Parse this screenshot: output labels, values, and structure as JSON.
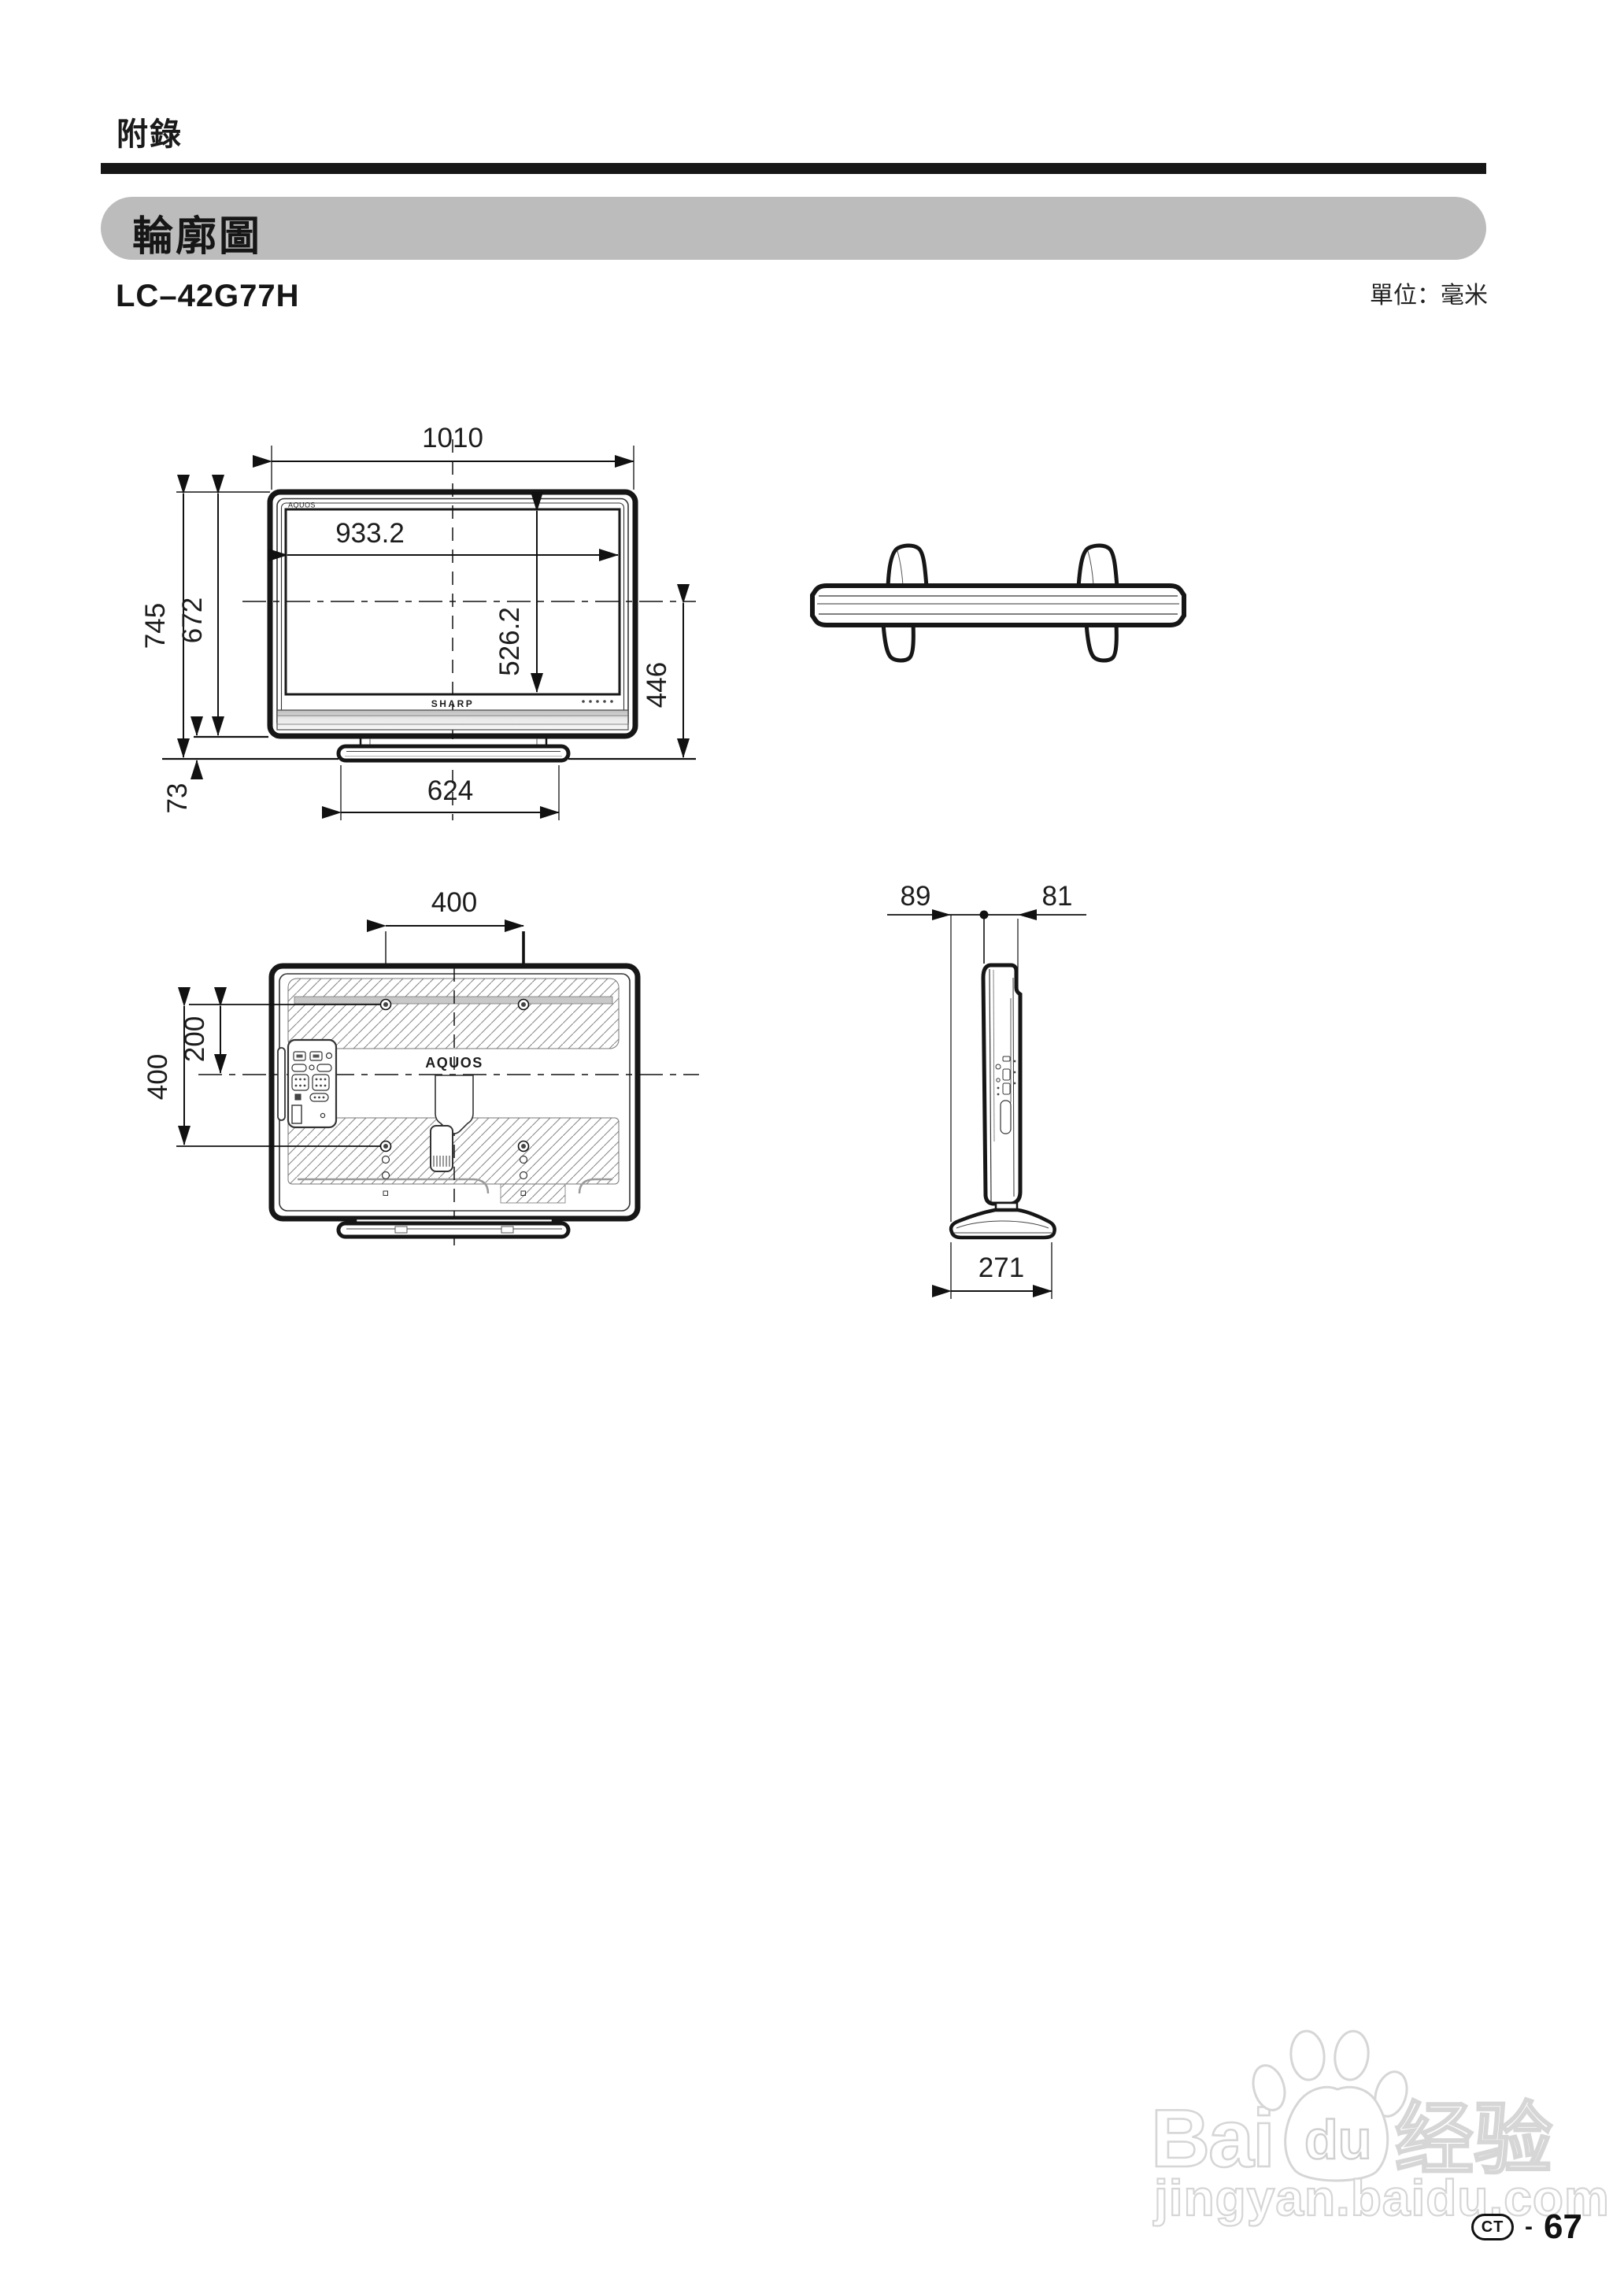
{
  "header": {
    "section_title": "附錄",
    "banner_title": "輪廓圖",
    "unit_label": "單位：毫米",
    "model": "LC–42G77H"
  },
  "colors": {
    "banner_bg": "#bcbcbc",
    "line": "#1a1a1a",
    "hatch": "#888888",
    "speaker_gray": "#c8c8c8",
    "watermark": "#d6d6d6"
  },
  "front_view": {
    "width_total": "1010",
    "width_screen": "933.2",
    "height_total": "745",
    "height_body": "672",
    "height_screen": "526.2",
    "height_center_to_floor": "446",
    "stand_height": "73",
    "stand_width": "624",
    "brand_top": "AQUOS",
    "brand_bottom": "SHARP"
  },
  "rear_view": {
    "mount_width": "400",
    "mount_offset_center": "200",
    "mount_height": "400",
    "brand": "AQUOS"
  },
  "side_view": {
    "depth_front": "89",
    "depth_back": "81",
    "base_depth": "271"
  },
  "watermark": {
    "logo_bai": "Bai",
    "logo_du": "du",
    "logo_suffix": "经验",
    "site_url": "jingyan.baidu.com"
  },
  "footer": {
    "code": "CT",
    "separator": "-",
    "page_number": "67"
  }
}
